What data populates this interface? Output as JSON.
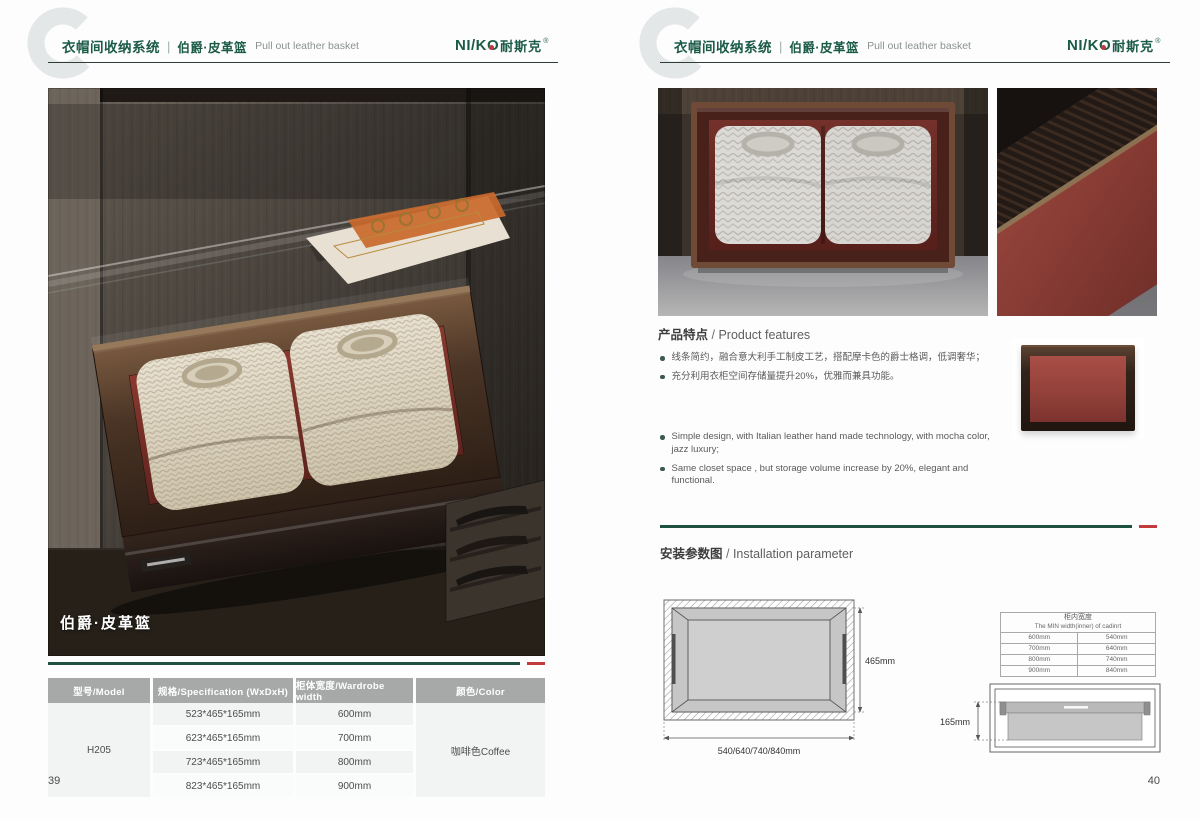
{
  "colors": {
    "brand_green": "#1b5a47",
    "accent_red": "#c13a3c"
  },
  "brand": {
    "latin": "NI/KO",
    "cn": "耐斯克",
    "reg": "®"
  },
  "header": {
    "system_cn": "衣帽间收纳系统",
    "divider": "|",
    "product_cn": "伯爵·皮革篮",
    "product_en": "Pull out leather basket"
  },
  "left_page": {
    "page_number": "39",
    "photo_caption": "伯爵·皮革篮",
    "spec_table": {
      "headers": [
        "型号/Model",
        "规格/Specification (WxDxH)",
        "柜体宽度/Wardrobe width",
        "颜色/Color"
      ],
      "model": "H205",
      "rows": [
        {
          "spec": "523*465*165mm",
          "width": "600mm"
        },
        {
          "spec": "623*465*165mm",
          "width": "700mm"
        },
        {
          "spec": "723*465*165mm",
          "width": "800mm"
        },
        {
          "spec": "823*465*165mm",
          "width": "900mm"
        }
      ],
      "color": "咖啡色Coffee"
    }
  },
  "right_page": {
    "page_number": "40",
    "features": {
      "heading_cn": "产品特点",
      "heading_sep": " / ",
      "heading_en": "Product features",
      "bullets_cn": [
        "线条简约，融合意大利手工制皮工艺，搭配摩卡色的爵士格调，低调奢华；",
        "充分利用衣柜空间存储量提升20%，优雅而兼具功能。"
      ],
      "bullets_en": [
        "Simple design, with Italian leather hand made technology, with mocha color, jazz  luxury;",
        "Same closet space ,  but storage volume increase by 20%, elegant and functional."
      ]
    },
    "installation": {
      "heading_cn": "安装参数图",
      "heading_sep": " / ",
      "heading_en": "Installation parameter",
      "top_view": {
        "depth_label": "465mm",
        "width_label": "540/640/740/840mm"
      },
      "min_width_table": {
        "title_cn": "柜内宽度",
        "title_en": "The MIN width(inner) of cadinrt",
        "rows": [
          [
            "600mm",
            "540mm"
          ],
          [
            "700mm",
            "640mm"
          ],
          [
            "800mm",
            "740mm"
          ],
          [
            "900mm",
            "840mm"
          ]
        ]
      },
      "side_view": {
        "height_label": "165mm"
      }
    }
  }
}
